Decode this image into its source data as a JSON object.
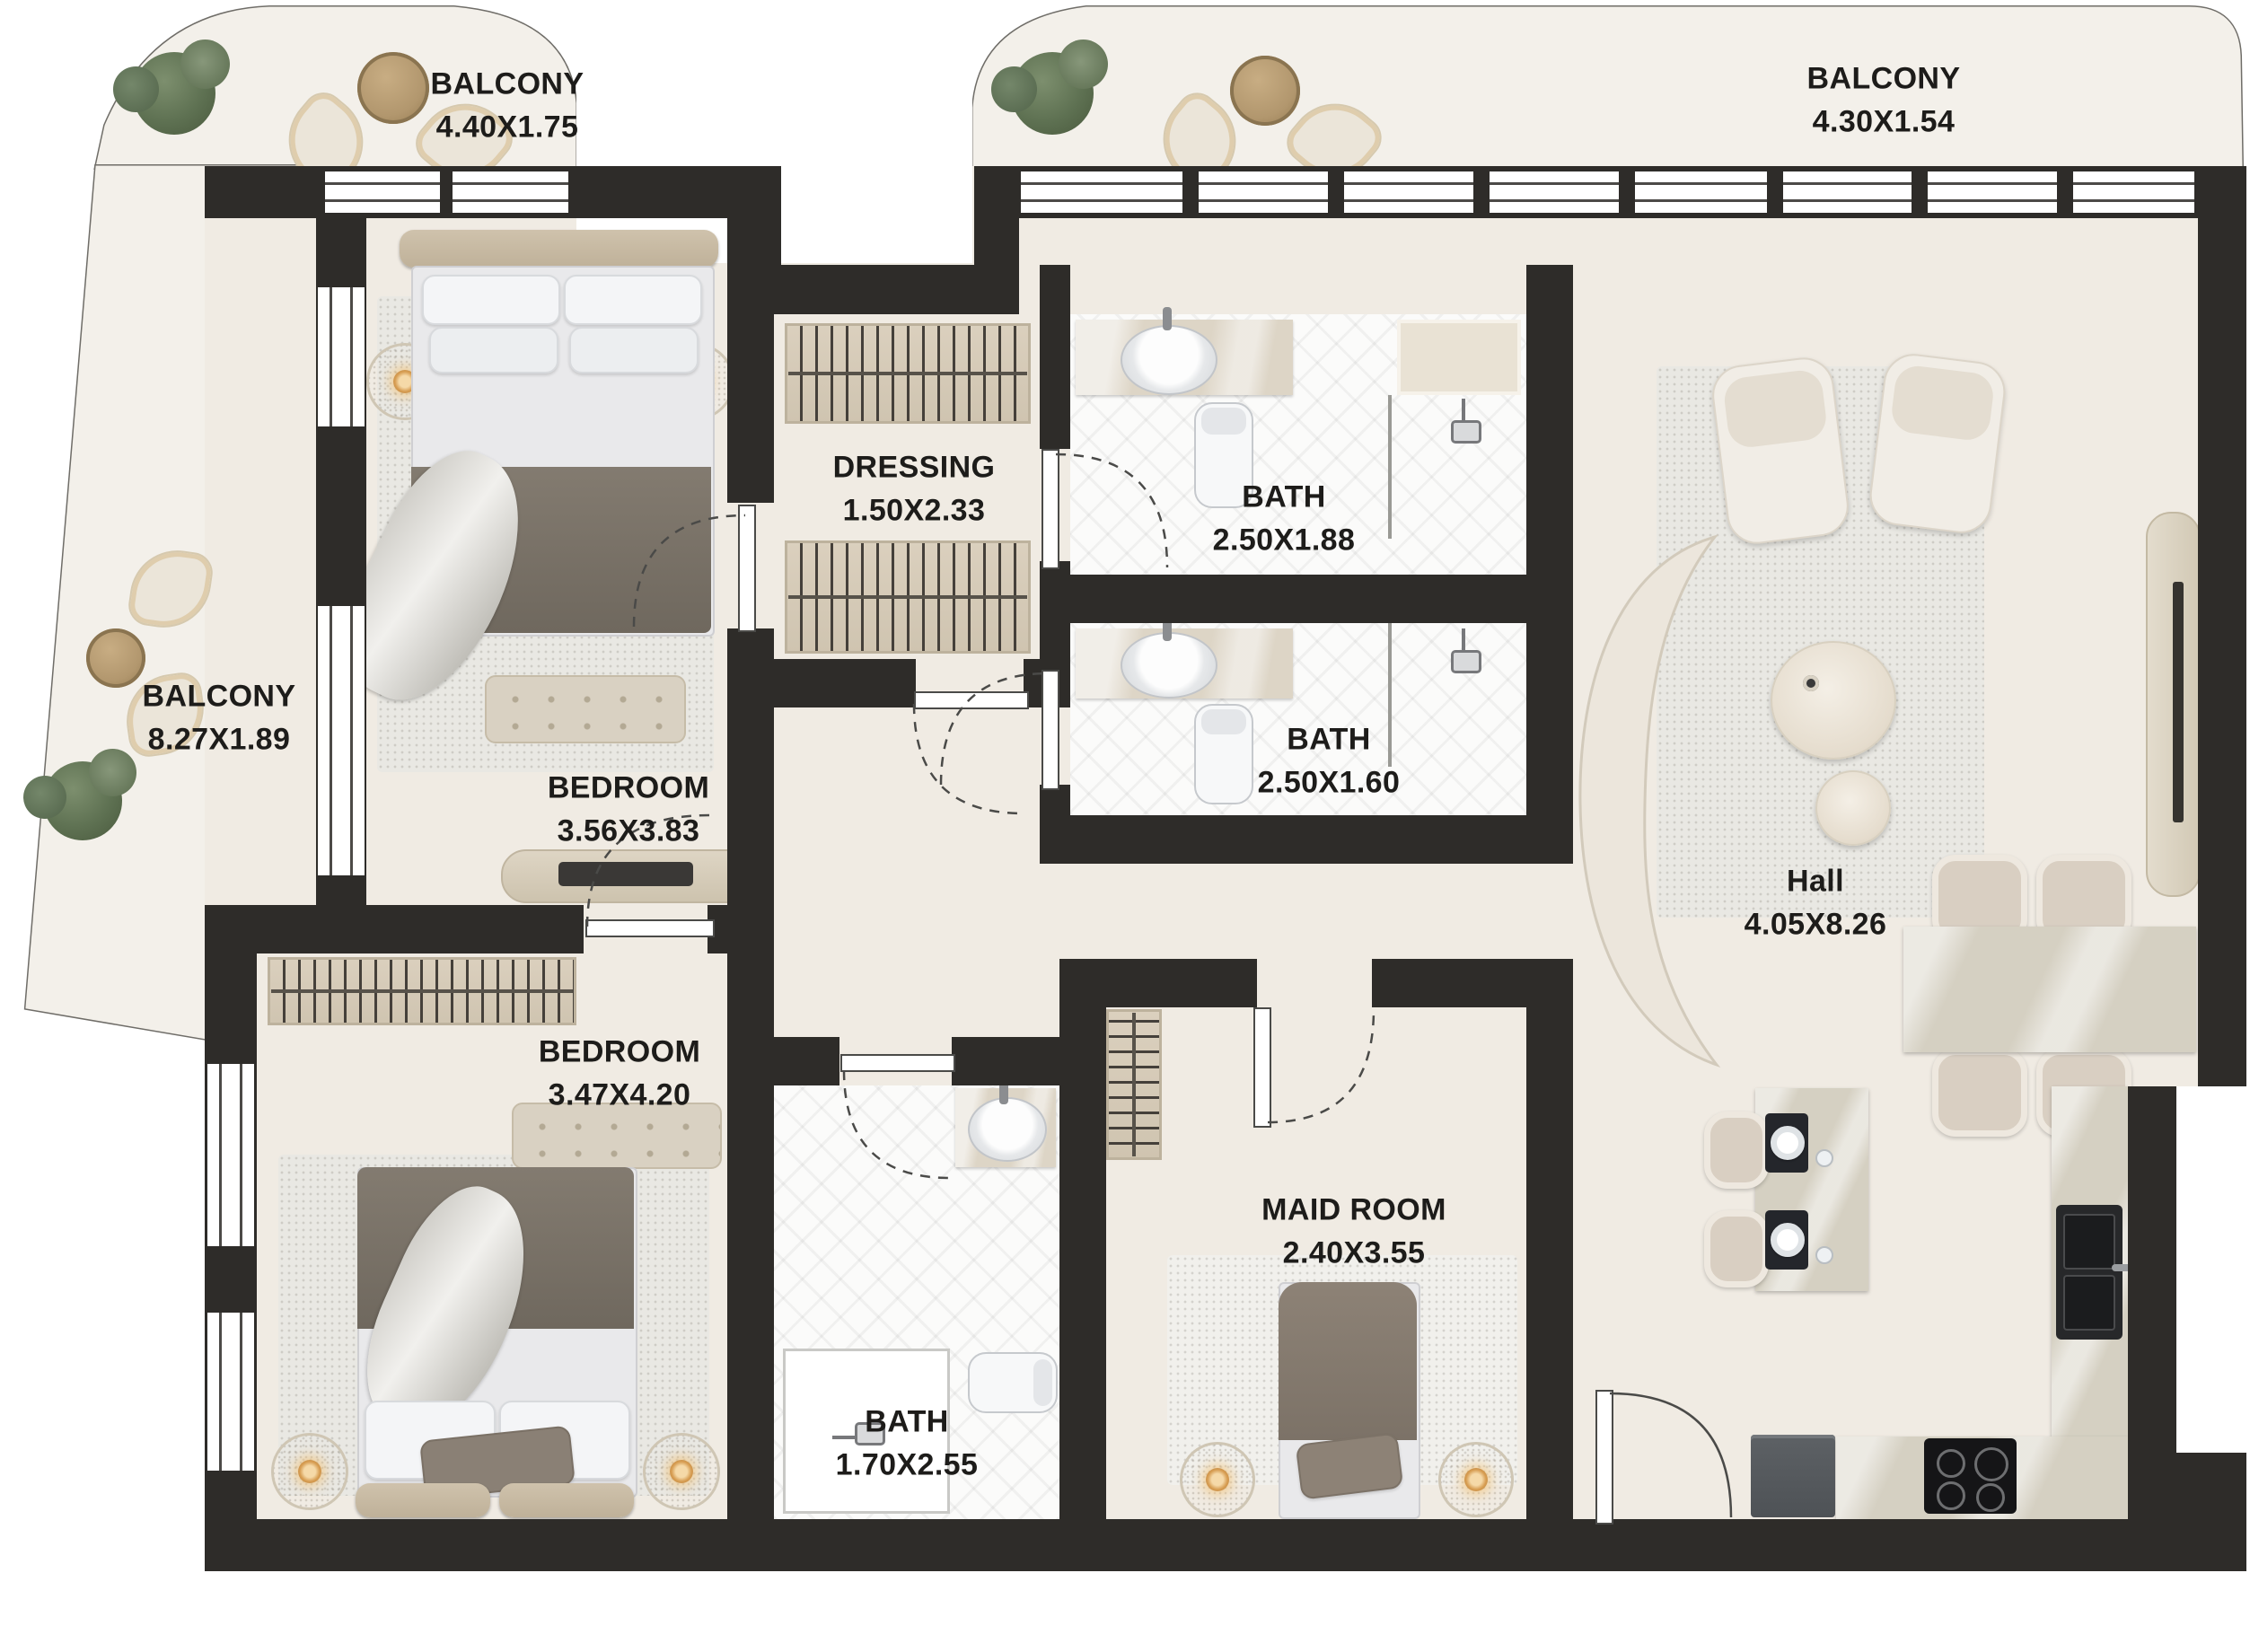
{
  "page": {
    "type": "apartment-floor-plan",
    "background": "#ffffff"
  },
  "rooms": [
    {
      "id": "balcony-top-left",
      "name": "BALCONY",
      "dims": "4.40X1.75"
    },
    {
      "id": "balcony-top-right",
      "name": "BALCONY",
      "dims": "4.30X1.54"
    },
    {
      "id": "balcony-left",
      "name": "BALCONY",
      "dims": "8.27X1.89"
    },
    {
      "id": "bedroom-top",
      "name": "BEDROOM",
      "dims": "3.56X3.83"
    },
    {
      "id": "dressing",
      "name": "DRESSING",
      "dims": "1.50X2.33"
    },
    {
      "id": "bath-ensuite",
      "name": "BATH",
      "dims": "2.50X1.88"
    },
    {
      "id": "bath-shared",
      "name": "BATH",
      "dims": "2.50X1.60"
    },
    {
      "id": "bedroom-bottom",
      "name": "BEDROOM",
      "dims": "3.47X4.20"
    },
    {
      "id": "bath-maid",
      "name": "BATH",
      "dims": "1.70X2.55"
    },
    {
      "id": "maid-room",
      "name": "MAID ROOM",
      "dims": "2.40X3.55"
    },
    {
      "id": "hall",
      "name": "Hall",
      "dims": "4.05X8.26"
    }
  ],
  "colors": {
    "wall": "#2e2c29",
    "floor": "#f0ebe3",
    "balcony_floor": "#f3f0ea",
    "bath_floor": "#fbfbfa",
    "wardrobe_wood": "#d6cbb9",
    "marble": "#d6d1c4",
    "rug": "#e9e8e3",
    "blanket": "#7d766c",
    "plant_green": "#5e7152",
    "table_wood": "#b2976e",
    "label_text": "#1d1c1a"
  }
}
